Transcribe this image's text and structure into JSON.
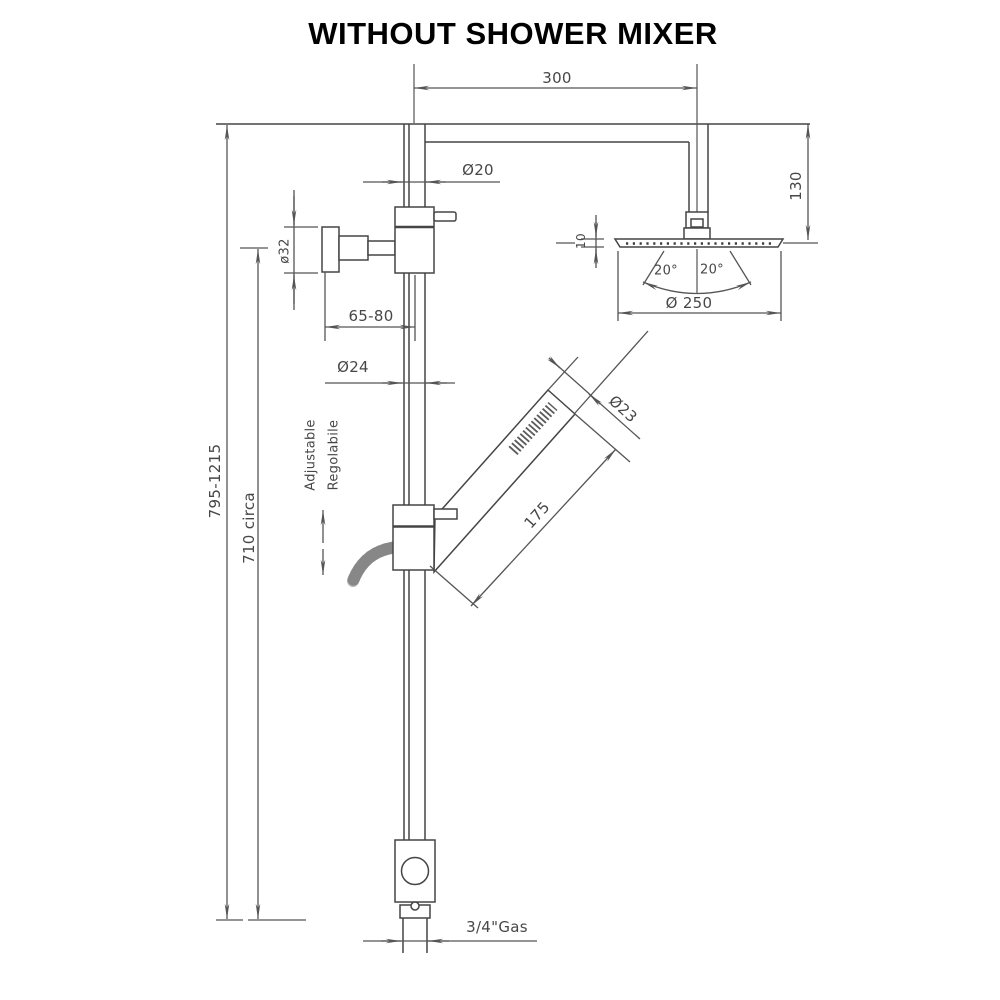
{
  "title": "WITHOUT SHOWER MIXER",
  "drawing": {
    "labels": {
      "arm_length": "300",
      "arm_diameter": "Ø20",
      "head_offset": "130",
      "head_thickness": "10",
      "spray_angle_left": "20°",
      "spray_angle_right": "20°",
      "head_diameter": "Ø 250",
      "wall_flange_diameter": "ø32",
      "wall_distance": "65-80",
      "pipe_diameter": "Ø24",
      "handshower_diameter": "Ø23",
      "handshower_length": "175",
      "total_height": "795-1215",
      "lower_height": "710 circa",
      "slider_note_en": "Adjustable",
      "slider_note_it": "Regolabile",
      "inlet_connection": "3/4\"Gas"
    },
    "colors": {
      "line": "#454545",
      "dimension_line": "#555555",
      "label_text": "#474747",
      "title_text": "#000000",
      "hose": "#b6b6b6",
      "background": "#ffffff"
    }
  }
}
